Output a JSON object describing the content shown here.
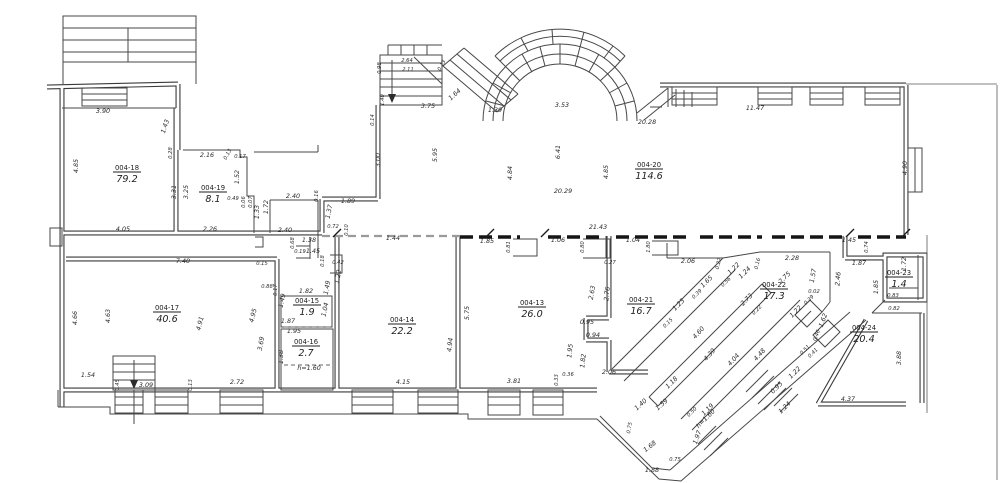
{
  "drawing": {
    "kind": "architectural-floor-plan",
    "line_color": "#3a3a3a",
    "background": "#ffffff",
    "rooms": [
      {
        "code": "004-18",
        "area": "79.2",
        "x": 127,
        "y": 174
      },
      {
        "code": "004-19",
        "area": "8.1",
        "x": 213,
        "y": 194
      },
      {
        "code": "004-20",
        "area": "114.6",
        "x": 649,
        "y": 171
      },
      {
        "code": "004-17",
        "area": "40.6",
        "x": 167,
        "y": 314
      },
      {
        "code": "004-15",
        "area": "1.9",
        "x": 307,
        "y": 307
      },
      {
        "code": "004-16",
        "area": "2.7",
        "x": 306,
        "y": 348
      },
      {
        "code": "004-14",
        "area": "22.2",
        "x": 402,
        "y": 326
      },
      {
        "code": "004-13",
        "area": "26.0",
        "x": 532,
        "y": 309
      },
      {
        "code": "004-21",
        "area": "16.7",
        "x": 641,
        "y": 306
      },
      {
        "code": "004-22",
        "area": "17.3",
        "x": 774,
        "y": 291
      },
      {
        "code": "004-23",
        "area": "1.4",
        "x": 899,
        "y": 279
      },
      {
        "code": "004-24",
        "area": "20.4",
        "x": 864,
        "y": 334
      }
    ],
    "dimensions": [
      {
        "t": "3.90",
        "x": 103,
        "y": 113
      },
      {
        "t": "1.43",
        "x": 167,
        "y": 127,
        "r": -72
      },
      {
        "t": "4.85",
        "x": 78,
        "y": 166,
        "r": -90
      },
      {
        "t": "0.28",
        "x": 172,
        "y": 153,
        "r": -90,
        "s": 1
      },
      {
        "t": "3.31",
        "x": 176,
        "y": 192,
        "r": -90
      },
      {
        "t": "4.05",
        "x": 123,
        "y": 231
      },
      {
        "t": "2.16",
        "x": 207,
        "y": 157
      },
      {
        "t": "0.13",
        "x": 229,
        "y": 155,
        "r": -62,
        "s": 1
      },
      {
        "t": "0.17",
        "x": 240,
        "y": 158,
        "s": 1
      },
      {
        "t": "1.52",
        "x": 239,
        "y": 177,
        "r": -90
      },
      {
        "t": "3.25",
        "x": 188,
        "y": 192,
        "r": -90
      },
      {
        "t": "0.49",
        "x": 233,
        "y": 200,
        "s": 1
      },
      {
        "t": "0.06",
        "x": 245,
        "y": 202,
        "r": -90,
        "s": 1
      },
      {
        "t": "0.07",
        "x": 252,
        "y": 202,
        "r": -90,
        "s": 1
      },
      {
        "t": "1.33",
        "x": 259,
        "y": 212,
        "r": -90
      },
      {
        "t": "1.72",
        "x": 268,
        "y": 207,
        "r": -90
      },
      {
        "t": "2.40",
        "x": 293,
        "y": 198
      },
      {
        "t": "0.16",
        "x": 318,
        "y": 196,
        "r": -90,
        "s": 1
      },
      {
        "t": "1.89",
        "x": 348,
        "y": 203
      },
      {
        "t": "1.37",
        "x": 331,
        "y": 212,
        "r": -78
      },
      {
        "t": "2.26",
        "x": 210,
        "y": 231
      },
      {
        "t": "2.40",
        "x": 285,
        "y": 232
      },
      {
        "t": "0.68",
        "x": 294,
        "y": 243,
        "r": -90,
        "s": 1
      },
      {
        "t": "1.38",
        "x": 309,
        "y": 242
      },
      {
        "t": "0.19",
        "x": 300,
        "y": 253,
        "s": 1
      },
      {
        "t": "1.45",
        "x": 313,
        "y": 253
      },
      {
        "t": "0.72",
        "x": 333,
        "y": 228,
        "s": 1
      },
      {
        "t": "0.10",
        "x": 348,
        "y": 230,
        "r": -90,
        "s": 1
      },
      {
        "t": "1.44",
        "x": 393,
        "y": 240
      },
      {
        "t": "2.64",
        "x": 407,
        "y": 62,
        "s": 1
      },
      {
        "t": "2.11",
        "x": 408,
        "y": 71,
        "s": 1
      },
      {
        "t": "0.13",
        "x": 443,
        "y": 66,
        "r": -62,
        "s": 1
      },
      {
        "t": "3.75",
        "x": 428,
        "y": 108
      },
      {
        "t": "1.64",
        "x": 456,
        "y": 96,
        "r": -42
      },
      {
        "t": "0.98",
        "x": 381,
        "y": 68,
        "r": -90,
        "s": 1
      },
      {
        "t": "1.40",
        "x": 384,
        "y": 100,
        "r": -90,
        "s": 1
      },
      {
        "t": "0.14",
        "x": 374,
        "y": 120,
        "r": -90,
        "s": 1
      },
      {
        "t": "1.39",
        "x": 495,
        "y": 112
      },
      {
        "t": "3.53",
        "x": 562,
        "y": 107
      },
      {
        "t": "3.00",
        "x": 380,
        "y": 160,
        "r": -90
      },
      {
        "t": "5.95",
        "x": 437,
        "y": 155,
        "r": -90
      },
      {
        "t": "4.84",
        "x": 512,
        "y": 173,
        "r": -90
      },
      {
        "t": "6.41",
        "x": 560,
        "y": 152,
        "r": -90
      },
      {
        "t": "4.85",
        "x": 608,
        "y": 172,
        "r": -90
      },
      {
        "t": "20.29",
        "x": 563,
        "y": 193
      },
      {
        "t": "20.28",
        "x": 647,
        "y": 124
      },
      {
        "t": "11.47",
        "x": 755,
        "y": 110
      },
      {
        "t": "4.90",
        "x": 907,
        "y": 168,
        "r": -90
      },
      {
        "t": "21.43",
        "x": 598,
        "y": 229
      },
      {
        "t": "1.85",
        "x": 487,
        "y": 243
      },
      {
        "t": "0.81",
        "x": 510,
        "y": 247,
        "r": -90,
        "s": 1
      },
      {
        "t": "1.06",
        "x": 558,
        "y": 242
      },
      {
        "t": "0.80",
        "x": 584,
        "y": 247,
        "r": -90,
        "s": 1
      },
      {
        "t": "1.04",
        "x": 633,
        "y": 242
      },
      {
        "t": "1.80",
        "x": 650,
        "y": 247,
        "r": -90,
        "s": 1
      },
      {
        "t": "0.27",
        "x": 610,
        "y": 264,
        "s": 1
      },
      {
        "t": "1.45",
        "x": 849,
        "y": 242
      },
      {
        "t": "0.74",
        "x": 868,
        "y": 247,
        "r": -90,
        "s": 1
      },
      {
        "t": "1.87",
        "x": 859,
        "y": 265
      },
      {
        "t": "2.46",
        "x": 840,
        "y": 279,
        "r": -85
      },
      {
        "t": "1.72",
        "x": 906,
        "y": 264,
        "r": -90
      },
      {
        "t": "1.85",
        "x": 878,
        "y": 287,
        "r": -90
      },
      {
        "t": "0.83",
        "x": 893,
        "y": 297,
        "s": 1
      },
      {
        "t": "0.82",
        "x": 894,
        "y": 310,
        "s": 1
      },
      {
        "t": "3.88",
        "x": 901,
        "y": 358,
        "r": -90
      },
      {
        "t": "4.37",
        "x": 848,
        "y": 401
      },
      {
        "t": "7.40",
        "x": 183,
        "y": 263
      },
      {
        "t": "4.66",
        "x": 77,
        "y": 318,
        "r": -90
      },
      {
        "t": "4.63",
        "x": 110,
        "y": 316,
        "r": -90
      },
      {
        "t": "4.91",
        "x": 202,
        "y": 324,
        "r": -76
      },
      {
        "t": "4.95",
        "x": 255,
        "y": 316,
        "r": -76
      },
      {
        "t": "3.69",
        "x": 263,
        "y": 344,
        "r": -80
      },
      {
        "t": "1.54",
        "x": 88,
        "y": 377
      },
      {
        "t": "0.45",
        "x": 119,
        "y": 385,
        "r": -90,
        "s": 1
      },
      {
        "t": "3.09",
        "x": 146,
        "y": 387
      },
      {
        "t": "0.13",
        "x": 192,
        "y": 385,
        "r": -90,
        "s": 1
      },
      {
        "t": "2.72",
        "x": 237,
        "y": 384
      },
      {
        "t": "0.15",
        "x": 262,
        "y": 265,
        "s": 1
      },
      {
        "t": "0.88",
        "x": 267,
        "y": 288,
        "s": 1
      },
      {
        "t": "0.17",
        "x": 277,
        "y": 290,
        "r": -90,
        "s": 1
      },
      {
        "t": "1.49",
        "x": 284,
        "y": 301,
        "r": -78
      },
      {
        "t": "0.18",
        "x": 324,
        "y": 261,
        "r": -90,
        "s": 1
      },
      {
        "t": "0.42",
        "x": 338,
        "y": 264,
        "s": 1
      },
      {
        "t": "1.22",
        "x": 340,
        "y": 277,
        "r": -80
      },
      {
        "t": "1.49",
        "x": 329,
        "y": 288,
        "r": -80
      },
      {
        "t": "1.82",
        "x": 306,
        "y": 293
      },
      {
        "t": "1.04",
        "x": 327,
        "y": 310,
        "r": -78
      },
      {
        "t": "1.87",
        "x": 288,
        "y": 323
      },
      {
        "t": "1.95",
        "x": 294,
        "y": 333
      },
      {
        "t": "1.38",
        "x": 283,
        "y": 357,
        "r": -90
      },
      {
        "t": "h=1.60",
        "x": 309,
        "y": 370
      },
      {
        "t": "4.94",
        "x": 452,
        "y": 345,
        "r": -84
      },
      {
        "t": "4.15",
        "x": 403,
        "y": 384
      },
      {
        "t": "5.75",
        "x": 469,
        "y": 313,
        "r": -90
      },
      {
        "t": "2.63",
        "x": 594,
        "y": 293,
        "r": -80
      },
      {
        "t": "2.76",
        "x": 609,
        "y": 294,
        "r": -84
      },
      {
        "t": "0.95",
        "x": 587,
        "y": 324
      },
      {
        "t": "0.94",
        "x": 593,
        "y": 337
      },
      {
        "t": "1.95",
        "x": 572,
        "y": 351,
        "r": -84
      },
      {
        "t": "1.82",
        "x": 585,
        "y": 361,
        "r": -84
      },
      {
        "t": "2.06",
        "x": 609,
        "y": 374
      },
      {
        "t": "3.81",
        "x": 514,
        "y": 383
      },
      {
        "t": "0.33",
        "x": 558,
        "y": 380,
        "r": -90,
        "s": 1
      },
      {
        "t": "0.36",
        "x": 568,
        "y": 376,
        "s": 1
      },
      {
        "t": "2.06",
        "x": 688,
        "y": 263
      },
      {
        "t": "0.22",
        "x": 720,
        "y": 264,
        "r": -76,
        "s": 1
      },
      {
        "t": "1.65",
        "x": 708,
        "y": 283,
        "r": -45
      },
      {
        "t": "0.39",
        "x": 698,
        "y": 295,
        "r": -45,
        "s": 1
      },
      {
        "t": "1.23",
        "x": 680,
        "y": 306,
        "r": -45
      },
      {
        "t": "0.15",
        "x": 669,
        "y": 324,
        "r": -45,
        "s": 1
      },
      {
        "t": "1.22",
        "x": 735,
        "y": 270,
        "r": -45
      },
      {
        "t": "0.56",
        "x": 727,
        "y": 283,
        "r": -45,
        "s": 1
      },
      {
        "t": "1.24",
        "x": 746,
        "y": 274,
        "r": -45
      },
      {
        "t": "0.16",
        "x": 759,
        "y": 264,
        "r": -76,
        "s": 1
      },
      {
        "t": "2.28",
        "x": 792,
        "y": 260
      },
      {
        "t": "2.75",
        "x": 786,
        "y": 279,
        "r": -45
      },
      {
        "t": "1.57",
        "x": 815,
        "y": 276,
        "r": -80
      },
      {
        "t": "0.02",
        "x": 814,
        "y": 293,
        "s": 1
      },
      {
        "t": "0.39",
        "x": 810,
        "y": 301,
        "r": -45,
        "s": 1
      },
      {
        "t": "1.22",
        "x": 797,
        "y": 313,
        "r": -45
      },
      {
        "t": "1.62",
        "x": 825,
        "y": 321,
        "r": -70
      },
      {
        "t": "2.73",
        "x": 748,
        "y": 301,
        "r": -45
      },
      {
        "t": "0.22",
        "x": 758,
        "y": 311,
        "r": -45,
        "s": 1
      },
      {
        "t": "4.60",
        "x": 700,
        "y": 334,
        "r": -48
      },
      {
        "t": "4.39",
        "x": 711,
        "y": 356,
        "r": -48
      },
      {
        "t": "4.04",
        "x": 735,
        "y": 361,
        "r": -48
      },
      {
        "t": "4.48",
        "x": 761,
        "y": 356,
        "r": -48
      },
      {
        "t": "1.18",
        "x": 673,
        "y": 384,
        "r": -45
      },
      {
        "t": "0.46",
        "x": 818,
        "y": 336,
        "r": -70,
        "s": 1
      },
      {
        "t": "0.51",
        "x": 806,
        "y": 351,
        "r": -45,
        "s": 1
      },
      {
        "t": "0.41",
        "x": 814,
        "y": 354,
        "r": -45,
        "s": 1
      },
      {
        "t": "1.22",
        "x": 796,
        "y": 374,
        "r": -45
      },
      {
        "t": "0.95",
        "x": 778,
        "y": 389,
        "r": -45
      },
      {
        "t": "1.24",
        "x": 786,
        "y": 409,
        "r": -45
      },
      {
        "t": "1.40",
        "x": 642,
        "y": 406,
        "r": -42
      },
      {
        "t": "1.59",
        "x": 663,
        "y": 406,
        "r": -42
      },
      {
        "t": "0.75",
        "x": 631,
        "y": 428,
        "r": -80,
        "s": 1
      },
      {
        "t": "1.19",
        "x": 709,
        "y": 411,
        "r": -45
      },
      {
        "t": "h=1.60",
        "x": 707,
        "y": 420,
        "r": -45
      },
      {
        "t": "0.50",
        "x": 693,
        "y": 413,
        "r": -45,
        "s": 1
      },
      {
        "t": "1.97",
        "x": 699,
        "y": 438,
        "r": -70
      },
      {
        "t": "1.68",
        "x": 651,
        "y": 448,
        "r": -38
      },
      {
        "t": "0.75",
        "x": 675,
        "y": 461,
        "s": 1
      },
      {
        "t": "1.88",
        "x": 652,
        "y": 472
      }
    ]
  }
}
